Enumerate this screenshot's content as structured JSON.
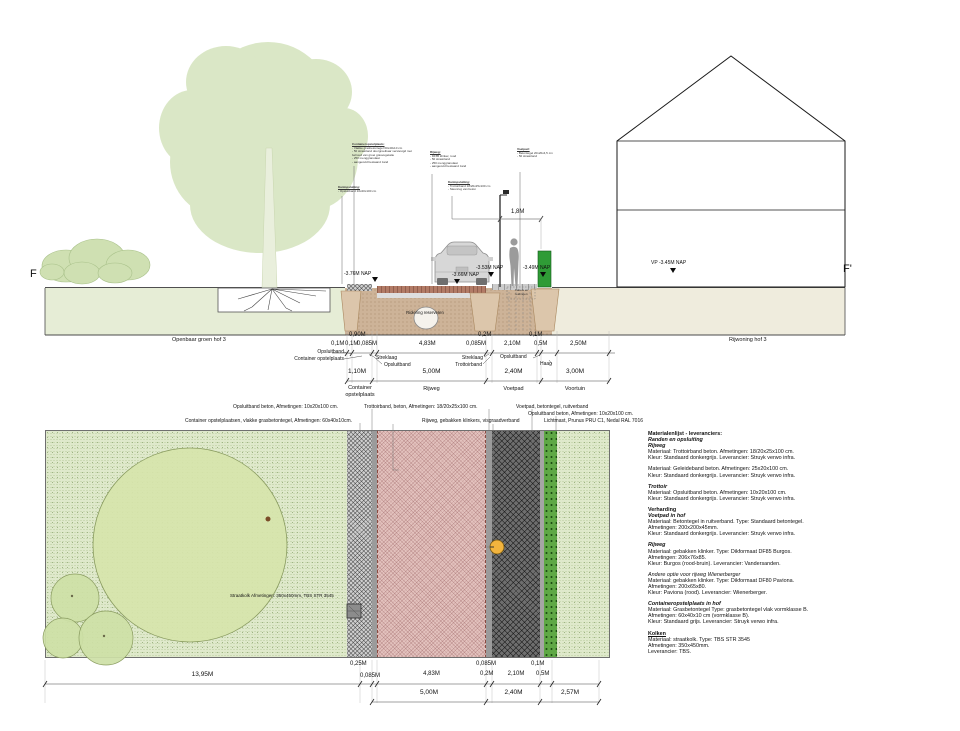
{
  "section": {
    "marker_left": "F",
    "marker_right": "F'",
    "nap_1": "-3.76M NAP",
    "nap_2": "-3.66M NAP",
    "nap_3": "-3.53M NAP",
    "nap_4": "-3.49M NAP",
    "nap_vp": "VP -3.45M NAP",
    "area_left": "Openbaar groen hof 3",
    "area_right": "Rijwoning hof 3",
    "lamp_dim": "1,8M",
    "riool": "Riolering reserveren",
    "kast": "Kabels en leidingen",
    "callouts": [
      {
        "title": "Containeropstelplaats:",
        "lines": [
          "- Vlakke grasbetontegel 60x40x10 cm",
          "- 50 straatzand doorgroeibaar verstevigd met behoud van groei grasvegetatie",
          "- 250 menggranulaat",
          "- aangevuld bestaand zand"
        ]
      },
      {
        "title": "Kantopsluiting:",
        "lines": [
          "- Opsluitband 10x20x100 cm"
        ]
      },
      {
        "title": "Rijweg:",
        "lines": [
          "- DF85 klinker, rood",
          "- 50 straatzand",
          "- 250 menggranulaat",
          "- aangevuld bestaand zand"
        ]
      },
      {
        "title": "Kantopsluiting:",
        "lines": [
          "- Trottoirband 18/20x25x100 cm",
          "- Steunrug van beton"
        ]
      },
      {
        "title": "Voetpad:",
        "lines": [
          "- Betontegel 20x20x4,5 cm",
          "- 50 straatzand"
        ]
      }
    ]
  },
  "section_dims": {
    "small": [
      "0,90M",
      "0,2M",
      "0,1M"
    ],
    "detail": [
      "0,1M",
      "0,1M",
      "0,085M",
      "4,83M",
      "0,085M",
      "2,10M",
      "0,5M",
      "2,50M"
    ],
    "leader_opsluitband_left": "Opsluitband",
    "leader_container_left": "Container opstelplaats",
    "leader_streklaag_1": "Streklaag",
    "leader_opsluitband_1": "Opsluitband",
    "leader_streklaag_2": "Streklaag",
    "leader_trottoirband": "Trottoirband",
    "leader_opsluitband_2": "Opsluitband",
    "leader_haag": "Haag",
    "main": [
      "1,10M",
      "5,00M",
      "2,40M",
      "3,00M"
    ],
    "zones": [
      "Container opstelplaats",
      "Rijweg",
      "Voetpad",
      "Voortuin"
    ]
  },
  "plan": {
    "annotations": [
      "Opsluitband beton, Afmetingen: 10x20x100 cm.",
      "Trottoirband, beton, Afmetingen: 18/20x25x100 cm.",
      "Voetpad, betontegel, ruitverband",
      "Opsluitband beton, Afmetingen: 10x20x100 cm.",
      "Container opstelplaatsen, vlakke grasbetontegel, Afmetingen: 60x40x10cm.",
      "Rijweg, gebakken klinkers, visgraadverband",
      "Lichtmast, Prunus PRU C1, Nedal RAL 7016"
    ],
    "kolk_label": "Straatkolk Afmetingen: 350x450mm, TBS STR 3545",
    "dims_small": [
      "0,25M",
      "0,085M",
      "0,1M"
    ],
    "dims_detail": [
      "13,95M",
      "0,085M",
      "4,83M",
      "0,2M",
      "2,10M",
      "0,5M"
    ],
    "dims_main": [
      "5,00M",
      "2,40M",
      "2,57M"
    ]
  },
  "materials": {
    "heading": "Materialenlijst - leveranciers:",
    "groups": [
      {
        "title": "Randen en opsluiting",
        "items": [
          {
            "subtitle": "Rijweg",
            "lines": [
              "Materiaal: Trottoirband beton. Afmetingen: 18/20x25x100 cm.",
              "Kleur: Standaard donkergrijs. Leverancier: Struyk verwo infra."
            ]
          },
          {
            "subtitle": "",
            "lines": [
              "Materiaal: Geleideband beton. Afmetingen: 25x20x100 cm.",
              "Kleur: Standaard donkergrijs. Leverancier: Struyk verwo infra."
            ]
          },
          {
            "subtitle": "Trottoir",
            "lines": [
              "Materiaal: Opsluitband beton. Afmetingen: 10x20x100 cm.",
              "Kleur: Standaard donkergrijs. Leverancier: Struyk verwo infra."
            ]
          }
        ]
      },
      {
        "title": "Verharding",
        "items": [
          {
            "subtitle": "Voetpad in hof",
            "lines": [
              "Materiaal: Betontegel in ruitverband. Type: Standaard betontegel.",
              "Afmetingen: 200x200x45mm.",
              "Kleur: Standaard donkergrijs. Leverancier: Struyk verwo infra."
            ]
          },
          {
            "subtitle": "Rijweg",
            "lines": [
              "Materiaal: gebakken klinker. Type: Dikformaat DF85 Burgos.",
              "Afmetingen: 206x76x85.",
              "Kleur: Burgos (rood-bruin). Leverancier: Vandersanden."
            ]
          },
          {
            "subtitle": "Andere optie voor rijweg Wienerberger",
            "lines": [
              "Materiaal: gebakken klinker. Type: Dikformaat DF80 Paviona.",
              "Afmetingen: 200x65x80.",
              "Kleur: Paviona (rood). Leverancier: Wienerberger."
            ]
          },
          {
            "subtitle": "Containeropstelplaats in hof",
            "lines": [
              "Materiaal: Grasbetontegel Type: grasbetontegel vlak vormklasse B.",
              "Afmetingen: 60x40x10 cm (vormklasse B).",
              "Kleur: Standaard grijs. Leverancier: Struyk verwo infra."
            ]
          }
        ]
      },
      {
        "title": "Kolken",
        "items": [
          {
            "subtitle": "",
            "lines": [
              "Materiaal: straatkolk. Type: TBS STR 3545",
              "Afmetingen: 350x450mm.",
              "Leverancier: TBS."
            ]
          }
        ]
      }
    ]
  },
  "colors": {
    "lawn": "#dfe9cb",
    "rijweg_plan": "#e3c2be",
    "voetpad_plan": "#6e6e6e",
    "haag": "#2f9b36",
    "soil": "#cdb398",
    "lamp_marker": "#f2b43e"
  }
}
